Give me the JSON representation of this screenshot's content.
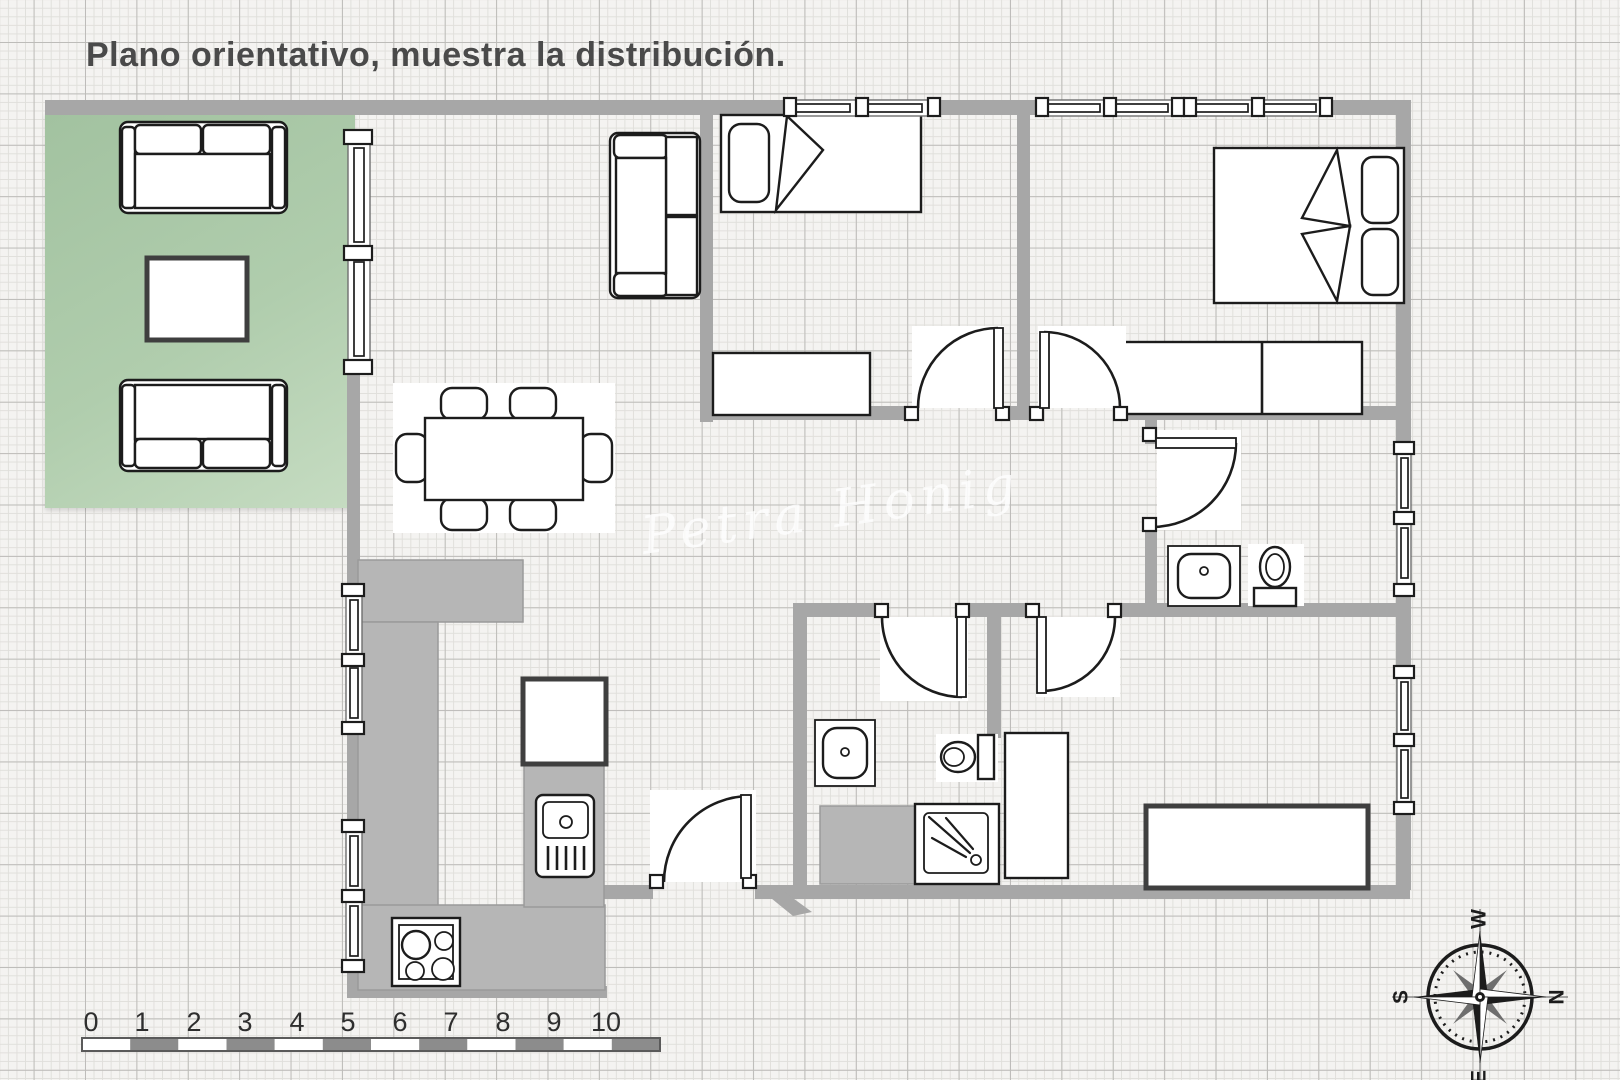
{
  "title": "Plano orientativo, muestra la distribución.",
  "watermark": "Petra Honig",
  "scale": {
    "labels": [
      "0",
      "1",
      "2",
      "3",
      "4",
      "5",
      "6",
      "7",
      "8",
      "9",
      "10"
    ]
  },
  "compass": {
    "west": "W",
    "north": "N",
    "east": "E",
    "south": "S"
  },
  "colors": {
    "paper": "#f4f3f1",
    "grid_minor": "#e0dfdb",
    "grid_major": "#bdbcb9",
    "wall": "#a7a7a7",
    "counter": "#b6b6b6",
    "living_dark": "#a2c2a0",
    "living_light": "#c6dcc2",
    "outline": "#1c1c1c",
    "title_text": "#4a4a4a",
    "scale_text": "#2e2e2e",
    "scale_bar_dark": "#8c8c8c",
    "watermark_text": "#ffffff"
  }
}
